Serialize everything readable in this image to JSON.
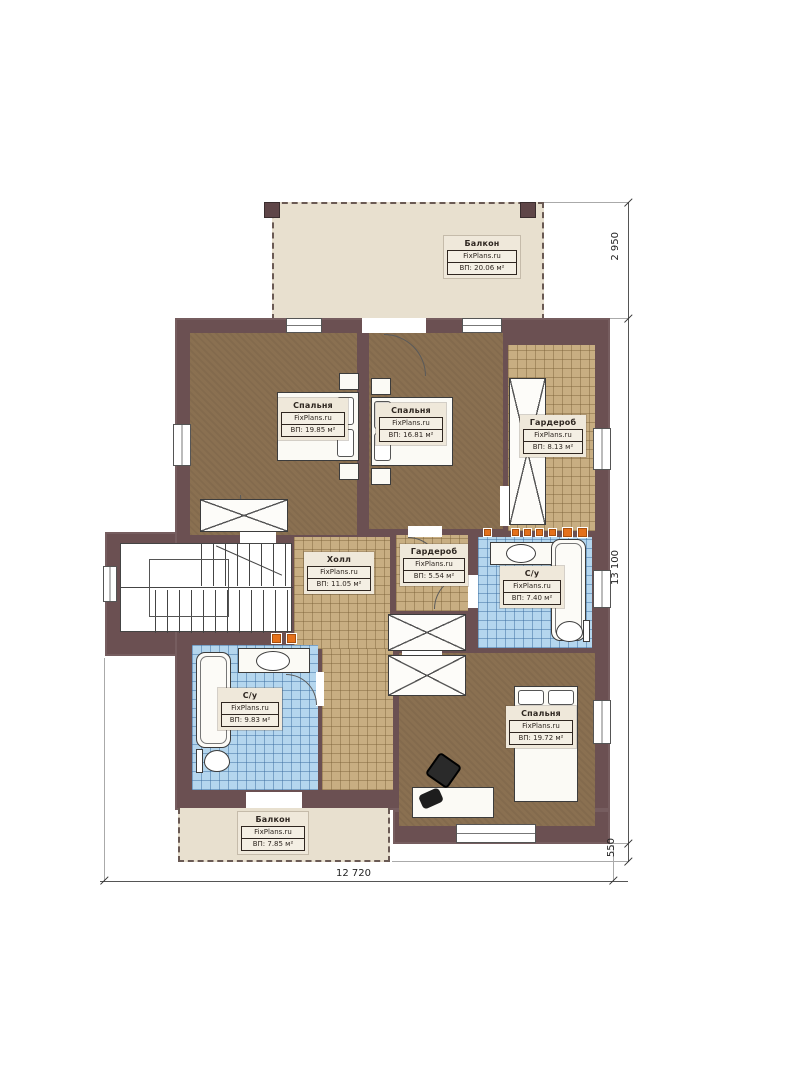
{
  "rooms": [
    {
      "id": "balcony-top",
      "name": "Балкон",
      "brand": "FixPlans.ru",
      "area": "ВП: 20.06 м²"
    },
    {
      "id": "bedroom-top-left",
      "name": "Спальня",
      "brand": "FixPlans.ru",
      "area": "ВП: 19.85 м²"
    },
    {
      "id": "bedroom-top-middle",
      "name": "Спальня",
      "brand": "FixPlans.ru",
      "area": "ВП: 16.81 м²"
    },
    {
      "id": "wardrobe-right",
      "name": "Гардероб",
      "brand": "FixPlans.ru",
      "area": "ВП: 8.13 м²"
    },
    {
      "id": "hall",
      "name": "Холл",
      "brand": "FixPlans.ru",
      "area": "ВП: 11.05 м²"
    },
    {
      "id": "wardrobe-middle",
      "name": "Гардероб",
      "brand": "FixPlans.ru",
      "area": "ВП: 5.54 м²"
    },
    {
      "id": "bathroom-right",
      "name": "С/у",
      "brand": "FixPlans.ru",
      "area": "ВП: 7.40 м²"
    },
    {
      "id": "bathroom-left",
      "name": "С/у",
      "brand": "FixPlans.ru",
      "area": "ВП: 9.83 м²"
    },
    {
      "id": "bedroom-bottom",
      "name": "Спальня",
      "brand": "FixPlans.ru",
      "area": "ВП: 19.72 м²"
    },
    {
      "id": "balcony-bottom",
      "name": "Балкон",
      "brand": "FixPlans.ru",
      "area": "ВП: 7.85 м²"
    }
  ],
  "dimensions": {
    "right_top": "2 950",
    "right_main": "13 100",
    "right_bottom": "550",
    "bottom": "12 720"
  },
  "colors": {
    "wall": "#6b5052",
    "carpet": "#8a7051",
    "tile_tan": "#c8ae82",
    "tile_blue": "#b4d6ee",
    "balcony": "#e8e0cf",
    "accent_orange": "#e4711c"
  }
}
